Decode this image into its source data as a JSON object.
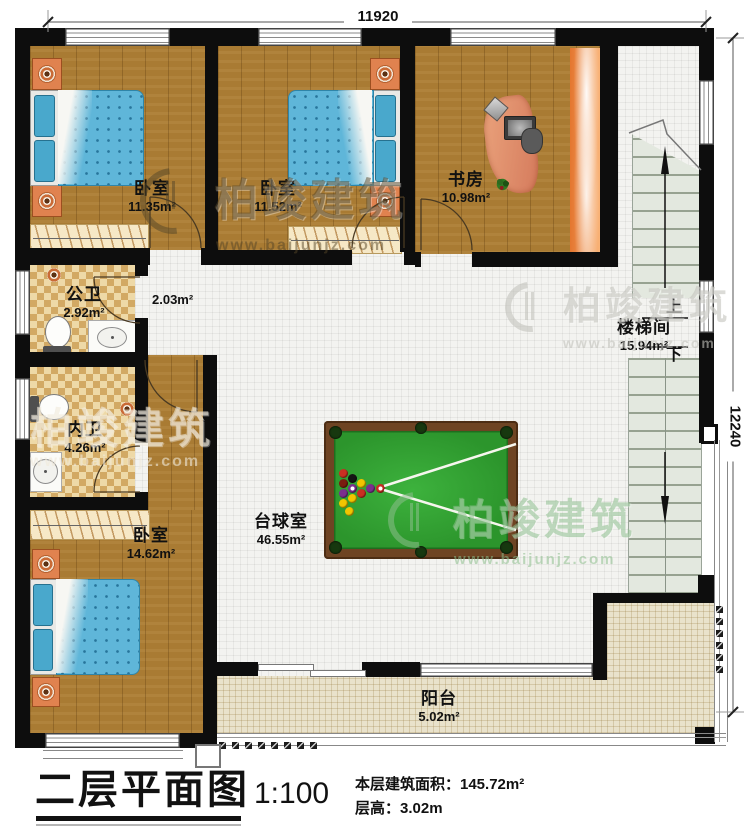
{
  "dimensions": {
    "top": "11920",
    "right": "12240"
  },
  "rooms": {
    "bedroom_top_left": {
      "name": "卧室",
      "area": "11.35m²"
    },
    "bedroom_top_mid": {
      "name": "卧室",
      "area": "11.52m²"
    },
    "study": {
      "name": "书房",
      "area": "10.98m²"
    },
    "stairwell": {
      "name": "楼梯间",
      "area": "15.94m²",
      "up_label": "上",
      "down_label": "下"
    },
    "public_bathroom": {
      "name": "公卫",
      "area": "2.92m²"
    },
    "hallway": {
      "area": "2.03m²"
    },
    "private_bathroom": {
      "name": "内卫",
      "area": "4.26m²"
    },
    "bedroom_bottom_left": {
      "name": "卧室",
      "area": "14.62m²"
    },
    "billiard_room": {
      "name": "台球室",
      "area": "46.55m²"
    },
    "balcony": {
      "name": "阳台",
      "area": "5.02m²"
    }
  },
  "footer": {
    "title": "二层平面图",
    "scale": "1:100",
    "floor_area": "本层建筑面积：145.72m²",
    "floor_height": "层高：3.02m"
  },
  "watermark": {
    "brand": "柏竣建筑",
    "url": "www.baijunjz.com"
  },
  "colors": {
    "wall": "#0d0d0d",
    "wood": "#a97b33",
    "tile": "#f3f3f0",
    "balcony_tile": "#e9e2cb",
    "bath_tile_light": "#eed9a7",
    "bath_tile_dark": "#d2a964",
    "stair": "#e3e8df",
    "billiard_felt": "#2f9e2f",
    "billiard_frame": "#6e4423",
    "bed_blue": "#5fb6d9",
    "nightstand_orange": "#e0824f",
    "bookshelf_orange": "#ef8c3f"
  }
}
